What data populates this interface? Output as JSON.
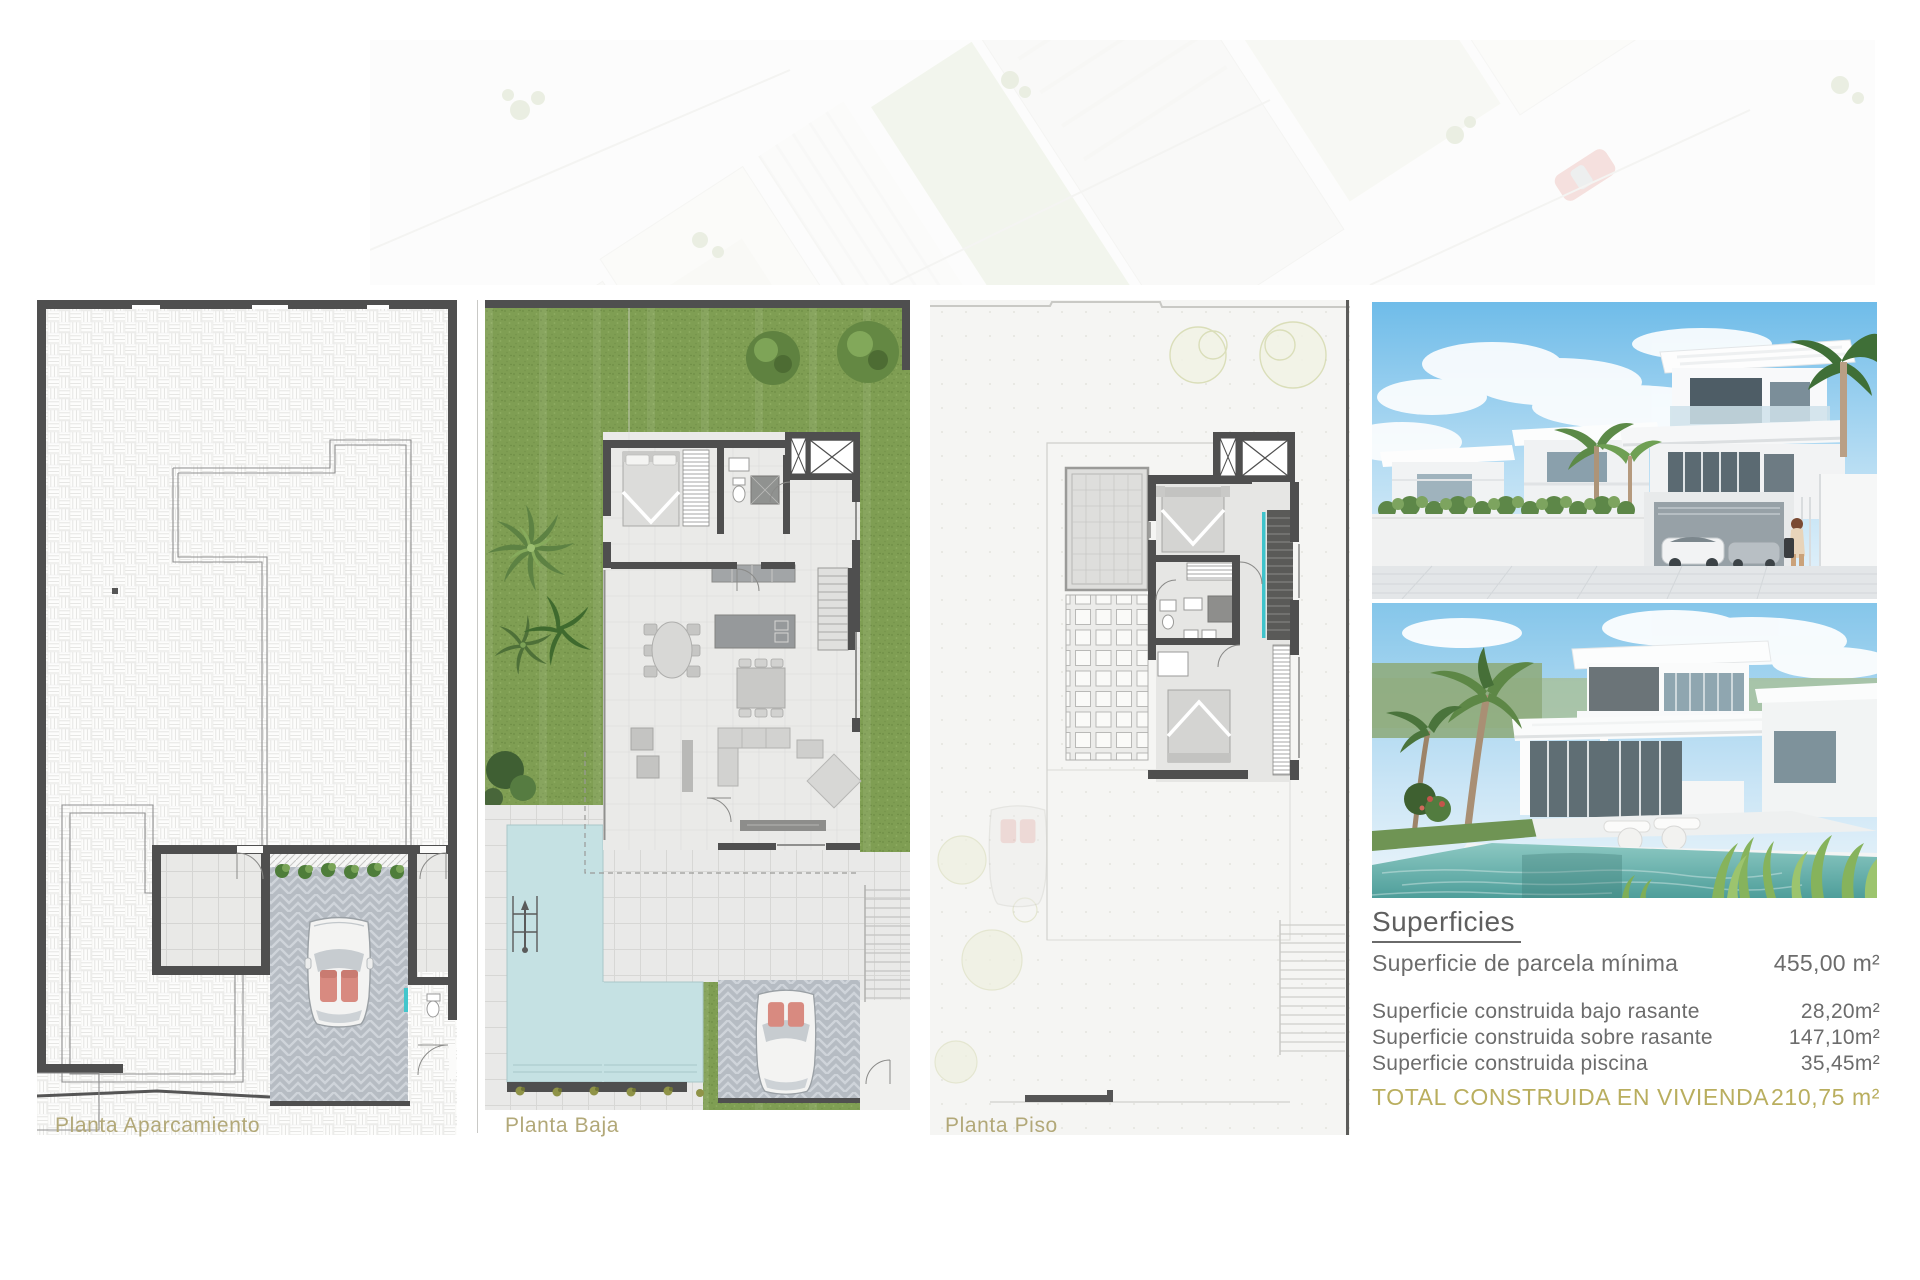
{
  "sheet": {
    "background": "#ffffff"
  },
  "plan_labels": {
    "aparcamiento": "Planta Aparcamiento",
    "baja": "Planta Baja",
    "piso": "Planta Piso"
  },
  "superficies": {
    "title": "Superficies",
    "rows": [
      {
        "label": "Superficie de parcela mínima",
        "value": "455,00 m²"
      },
      {
        "label": "Superficie construida bajo rasante",
        "value": "28,20m²"
      },
      {
        "label": "Superficie construida sobre rasante",
        "value": "147,10m²"
      },
      {
        "label": "Superficie construida piscina",
        "value": "35,45m²"
      }
    ],
    "total": {
      "label": "TOTAL CONSTRUIDA EN VIVIENDA",
      "value": "210,75 m²"
    }
  },
  "colors": {
    "accent_olive": "#b2a878",
    "total_gold": "#b9ae5e",
    "wall_dark": "#4f4f4f",
    "grass_green": "#7f9e53",
    "pool_blue": "#c5e1e3",
    "teal_accent": "#43c6cc",
    "text_gray": "#6c6c6c"
  }
}
